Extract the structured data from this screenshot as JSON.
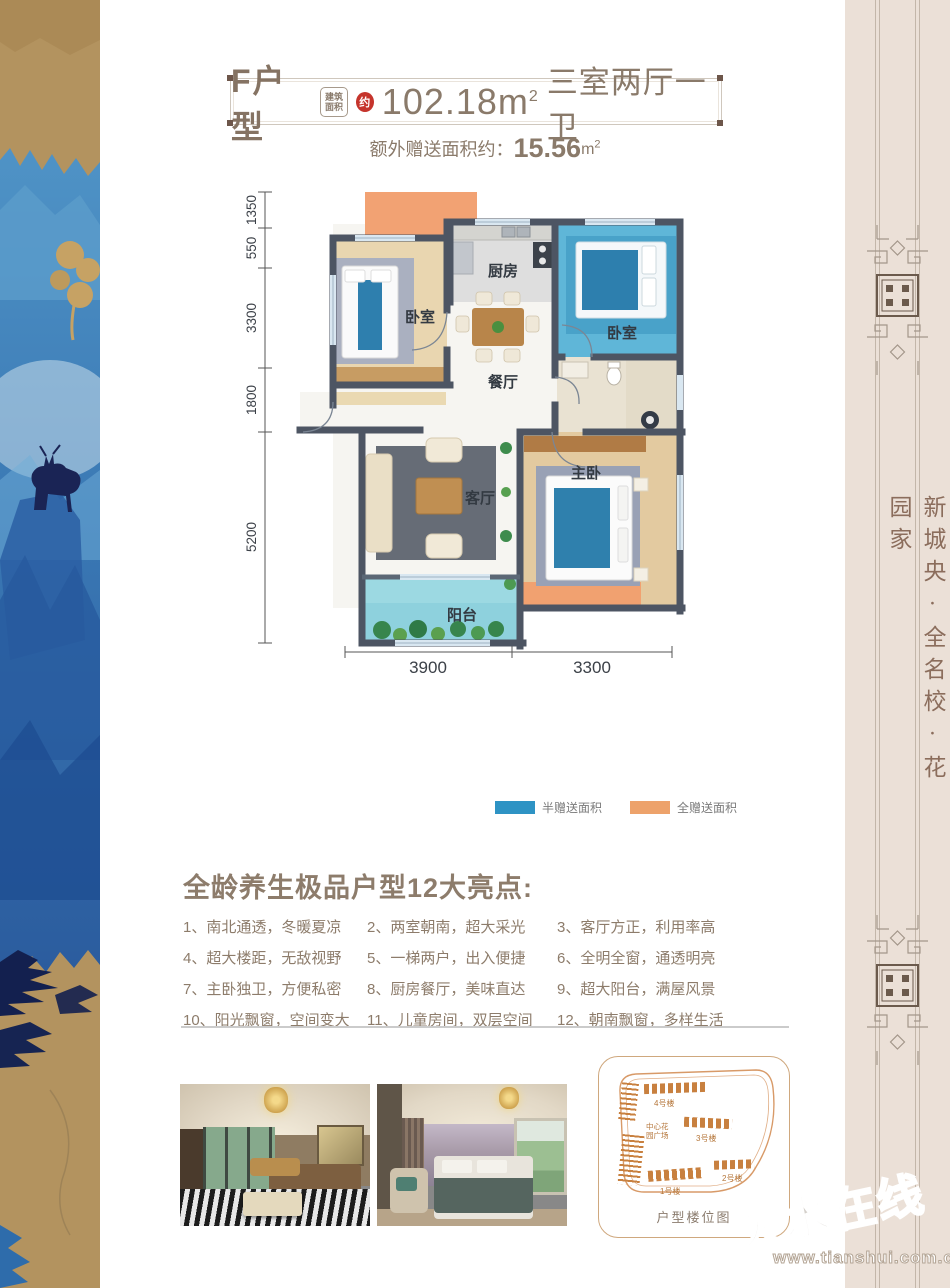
{
  "header": {
    "title": "F户型",
    "badge_top": "建筑",
    "badge_bottom": "面积",
    "approx": "约",
    "area_value": "102.18",
    "area_unit": "m",
    "area_sup": "2",
    "rooms_text": "三室两厅一卫",
    "bonus_label": "额外赠送面积约：",
    "bonus_value": "15.56",
    "bonus_unit": "m",
    "bonus_sup": "2"
  },
  "floorplan": {
    "rooms": {
      "kitchen": "厨房",
      "bedroom_left": "卧室",
      "bedroom_right": "卧室",
      "dining": "餐厅",
      "living": "客厅",
      "master": "主卧",
      "balcony": "阳台"
    },
    "dims_left": [
      "1350",
      "550",
      "3300",
      "1800",
      "5200"
    ],
    "dims_bottom": [
      "3900",
      "3300"
    ]
  },
  "legend": {
    "half_label": "半赠送面积",
    "full_label": "全赠送面积"
  },
  "highlights": {
    "title": "全龄养生极品户型12大亮点:",
    "items": [
      "1、南北通透，冬暖夏凉",
      "2、两室朝南，超大采光",
      "3、客厅方正，利用率高",
      "4、超大楼距，无敌视野",
      "5、一梯两户，出入便捷",
      "6、全明全窗，通透明亮",
      "7、主卧独卫，方便私密",
      "8、厨房餐厅，美味直达",
      "9、超大阳台，满屋风景",
      "10、阳光飘窗，空间变大",
      "11、儿童房间，双层空间",
      "12、朝南飘窗，多样生活"
    ]
  },
  "sitemap": {
    "caption": "户型楼位图",
    "plaza_line1": "中心花",
    "plaza_line2": "园广场",
    "buildings": [
      "4号楼",
      "3号楼",
      "2号楼",
      "1号楼"
    ]
  },
  "sidebar": {
    "slogan": "新城央·全名校·花园家"
  },
  "watermark": {
    "brand": "天水在线",
    "url": "www.tianshui.com.cn"
  },
  "colors": {
    "wall": "#4d5563",
    "half_gift_blue": "#2e93c4",
    "full_gift_orange": "#eda26b",
    "text_brown": "#8d7c6b",
    "balcony_teal": "#8ed1dd"
  }
}
